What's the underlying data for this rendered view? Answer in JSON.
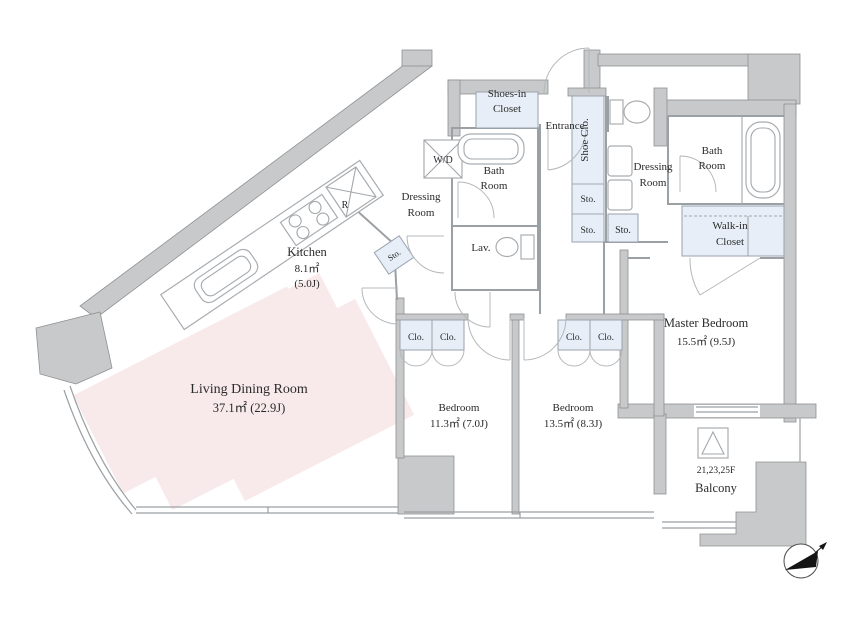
{
  "colors": {
    "wall_gray": "#c7c9ca",
    "storage_highlight_blue": "#e7eef7",
    "watermark_pink": "#f8eaea",
    "line_gray": "#9aa0a4",
    "text": "#2a2a2a"
  },
  "rooms": {
    "living_dining": {
      "name": "Living Dining Room",
      "area": "37.1㎡ (22.9J)"
    },
    "kitchen": {
      "name": "Kitchen",
      "area_m2": "8.1㎡",
      "area_tatami": "(5.0J)"
    },
    "bedroom_1": {
      "name": "Bedroom",
      "area": "11.3㎡ (7.0J)"
    },
    "bedroom_2": {
      "name": "Bedroom",
      "area": "13.5㎡ (8.3J)"
    },
    "master_bedroom": {
      "name": "Master Bedroom",
      "area": "15.5㎡ (9.5J)"
    },
    "balcony": {
      "name": "Balcony",
      "floor_note": "21,23,25F"
    }
  },
  "labels": {
    "shoes_in_closet_line1": "Shoes-in",
    "shoes_in_closet_line2": "Closet",
    "entrance": "Entrance",
    "shoe_closet": "Shoe Clo.",
    "bath_room_line1": "Bath",
    "bath_room_line2": "Room",
    "dressing_room_line1": "Dressing",
    "dressing_room_line2": "Room",
    "walk_in_closet_line1": "Walk-in",
    "walk_in_closet_line2": "Closet",
    "lavatory": "Lav.",
    "storage": "Sto.",
    "closet": "Clo.",
    "washer_dryer": "W/D",
    "refrigerator": "R"
  }
}
